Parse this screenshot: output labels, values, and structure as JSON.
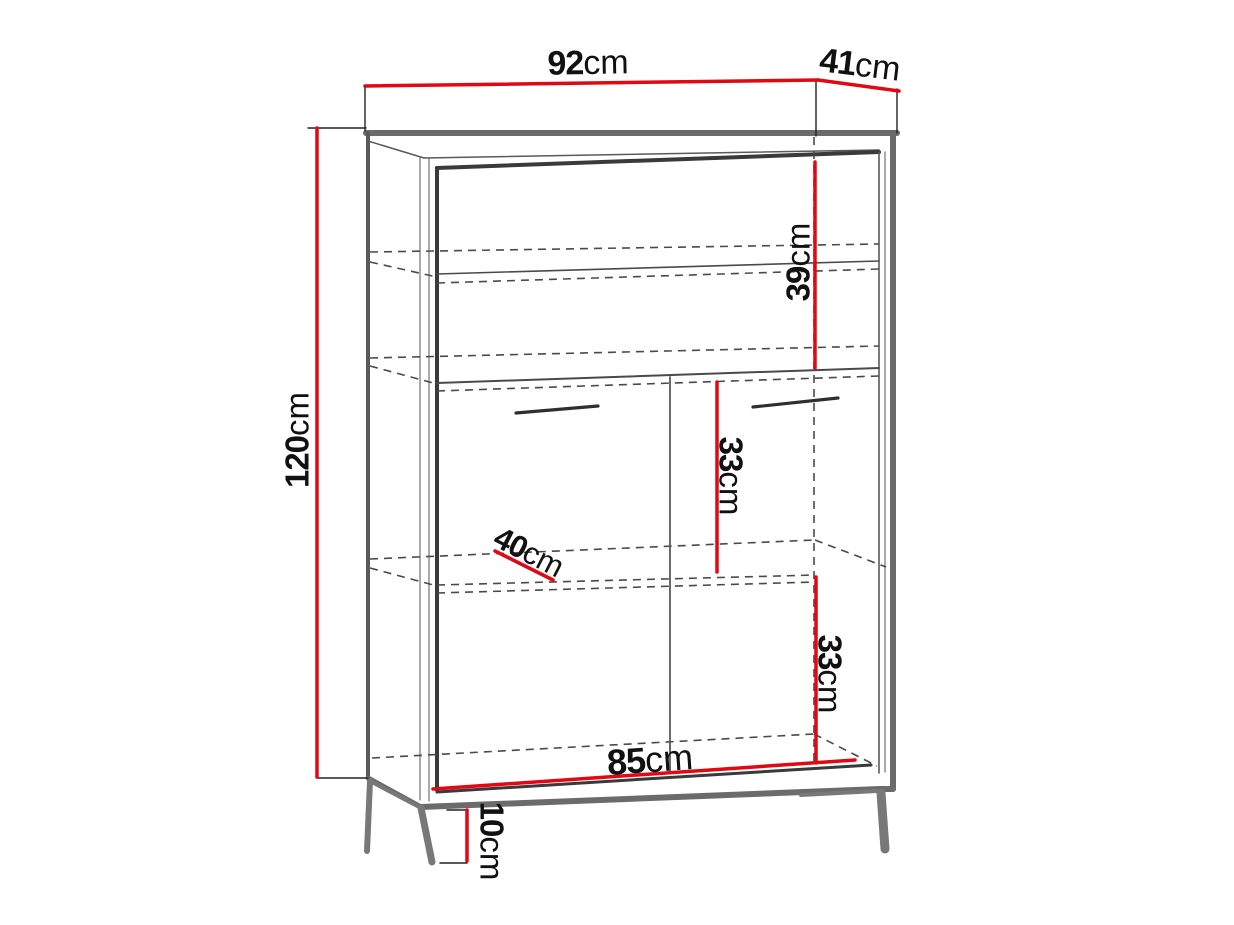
{
  "diagram": {
    "type": "furniture-dimension-drawing",
    "object": "two-door display cabinet on metal legs",
    "unit": "cm",
    "colors": {
      "accent_red": "#e30613",
      "line_dark": "#3a3a3a",
      "line_thick_gray": "#6b6b6b",
      "background": "#ffffff"
    },
    "dimensions": [
      {
        "id": "width",
        "value": "92",
        "unit": "cm"
      },
      {
        "id": "depth",
        "value": "41",
        "unit": "cm"
      },
      {
        "id": "height",
        "value": "120",
        "unit": "cm"
      },
      {
        "id": "upper-section",
        "value": "39",
        "unit": "cm"
      },
      {
        "id": "middle-section",
        "value": "33",
        "unit": "cm"
      },
      {
        "id": "lower-section",
        "value": "33",
        "unit": "cm"
      },
      {
        "id": "shelf-depth",
        "value": "40",
        "unit": "cm"
      },
      {
        "id": "interior-width",
        "value": "85",
        "unit": "cm"
      },
      {
        "id": "leg-height",
        "value": "10",
        "unit": "cm"
      }
    ]
  }
}
